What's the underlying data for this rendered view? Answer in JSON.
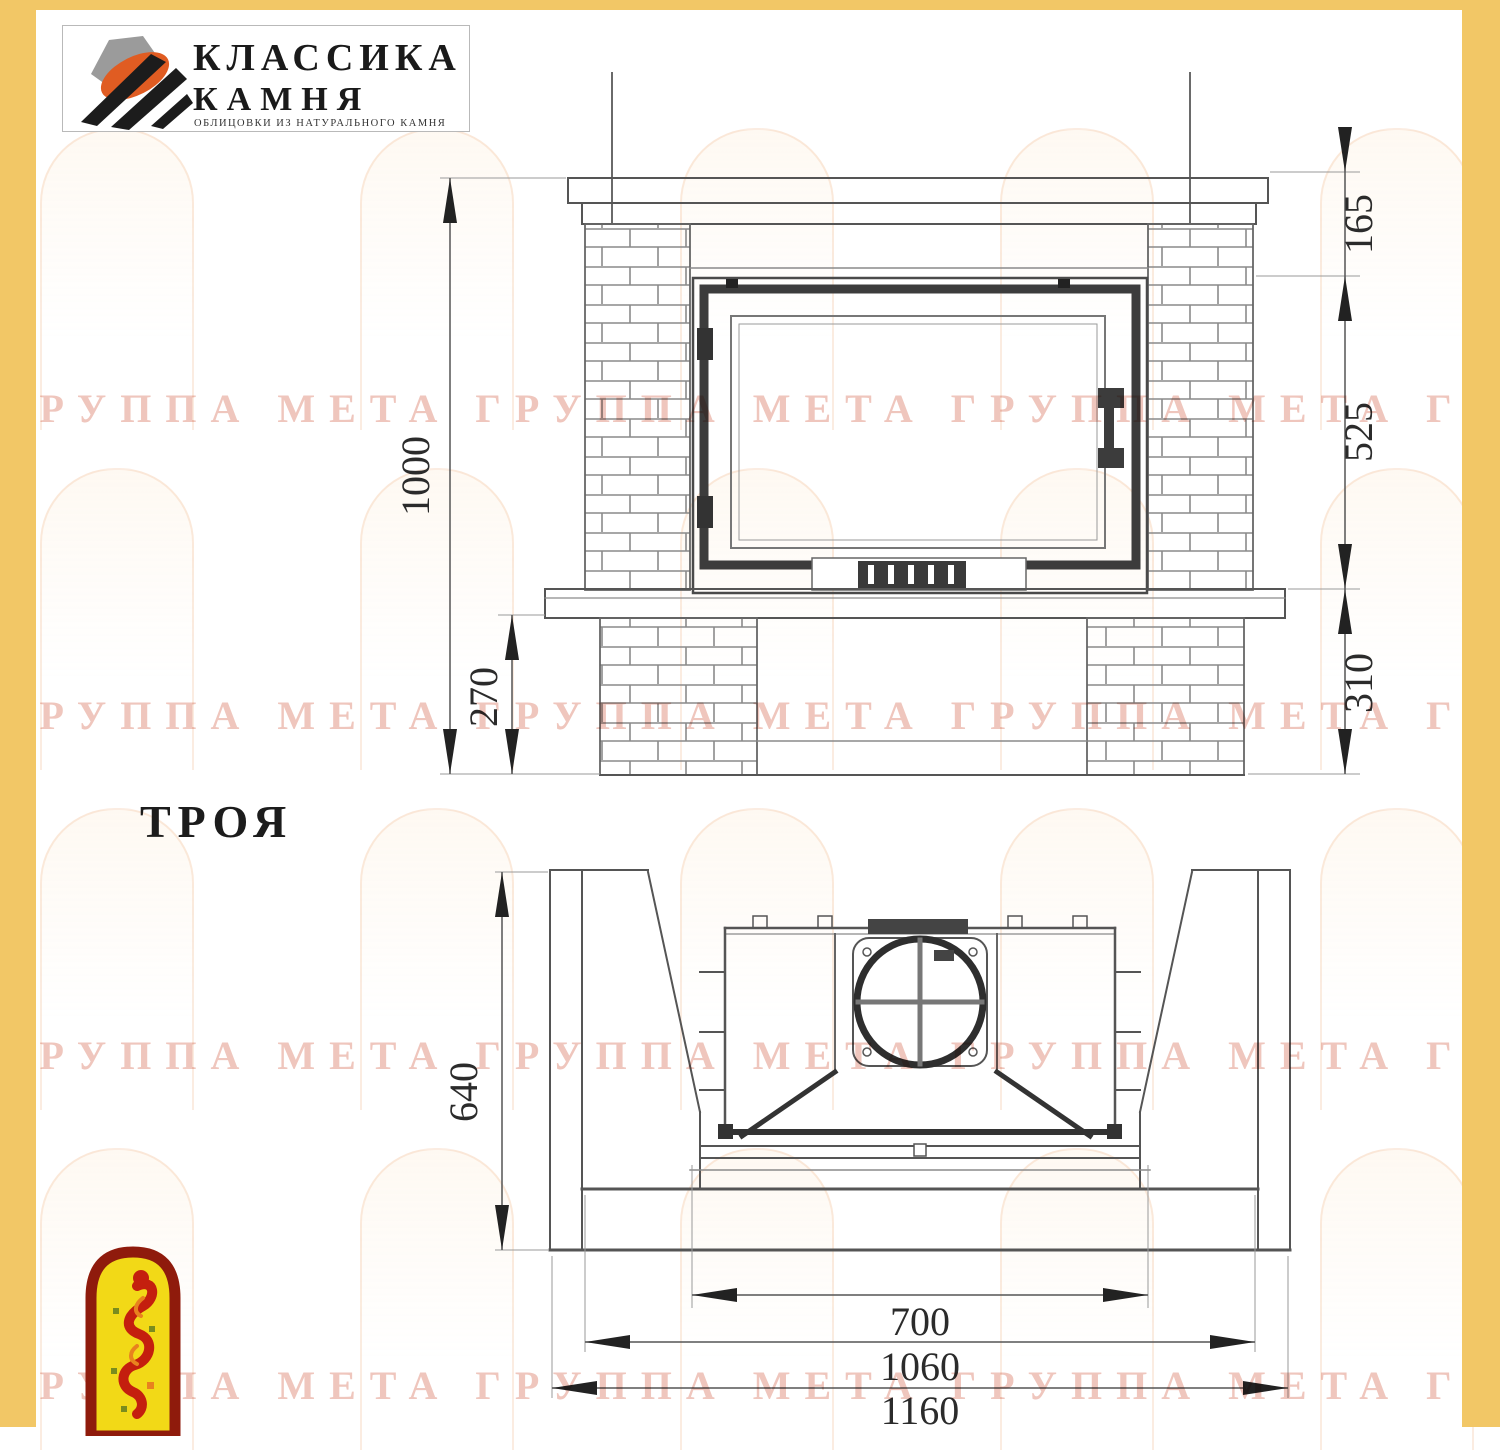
{
  "brand": {
    "name_line1": "КЛАССИКА",
    "name_line2": "КАМНЯ",
    "tagline": "ОБЛИЦОВКИ ИЗ НАТУРАЛЬНОГО КАМНЯ"
  },
  "title": {
    "model": "ТРОЯ"
  },
  "watermark": {
    "text": "ГРУППА МЕТА ГРУППА МЕТА ГРУППА МЕТА ГРУППА МЕТА ГРУППА МЕТА"
  },
  "front_view": {
    "dim_total_height": "1000",
    "dim_shelf_offset": "165",
    "dim_firebox_height": "525",
    "dim_hearth_height": "310",
    "dim_pedestal_height": "270"
  },
  "plan_view": {
    "dim_depth": "640",
    "dim_firebox_width": "700",
    "dim_body_width": "1060",
    "dim_overall_width": "1160"
  },
  "colors": {
    "frame_yellow": "#f2c766",
    "line_dark": "#3a3a3a",
    "line_mid": "#5a5a5a",
    "brick_line": "#8a8a8a",
    "watermark_pink": "#d97862",
    "logo_orange": "#e05c22",
    "emblem_red": "#c41f0e",
    "emblem_border": "#8f1b0c",
    "emblem_yellow": "#f2d917"
  }
}
